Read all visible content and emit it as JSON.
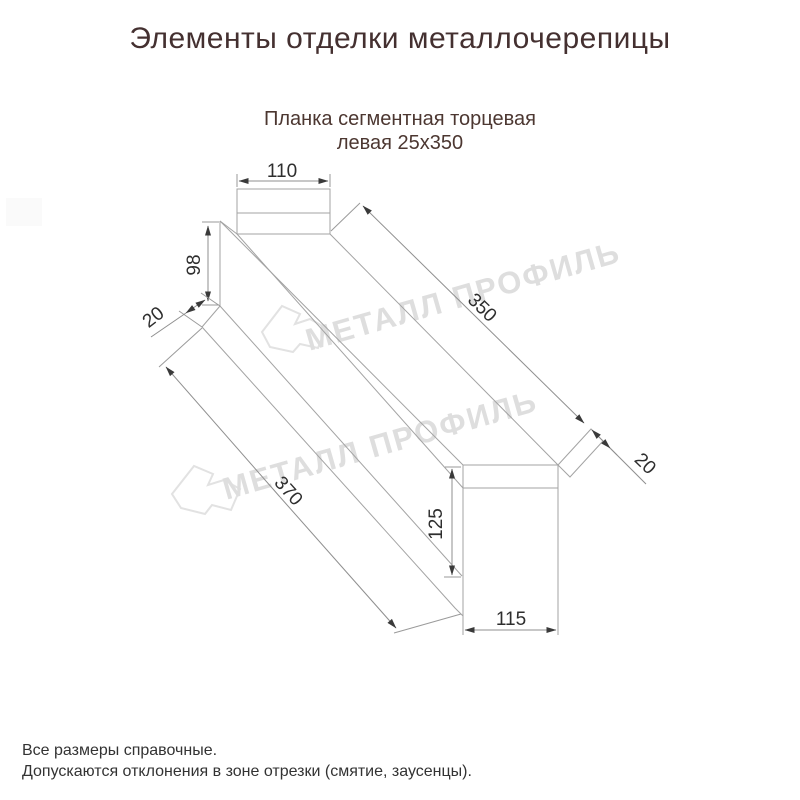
{
  "title": "Элементы отделки металлочерепицы",
  "subtitle": {
    "line1": "Планка сегментная торцевая",
    "line2": "левая 25x350"
  },
  "drawing": {
    "dimensions": {
      "top_flange_width": "110",
      "back_height": "98",
      "left_hem_width": "20",
      "top_edge_length": "350",
      "bottom_edge_length": "370",
      "front_face_height": "125",
      "bottom_face_width": "115",
      "right_hem_width": "20"
    }
  },
  "watermark": {
    "brand": "МЕТАЛЛ ПРОФИЛЬ"
  },
  "footer": {
    "line1": "Все размеры справочные.",
    "line2": "Допускаются отклонения в зоне отрезки (смятие, заусенцы)."
  },
  "colors": {
    "heading": "#443030",
    "subtitle": "#4c3731",
    "dimension_text": "#2e2e2e",
    "drawing_line": "#a3a3a3",
    "watermark": "#dedede",
    "background": "#ffffff"
  }
}
